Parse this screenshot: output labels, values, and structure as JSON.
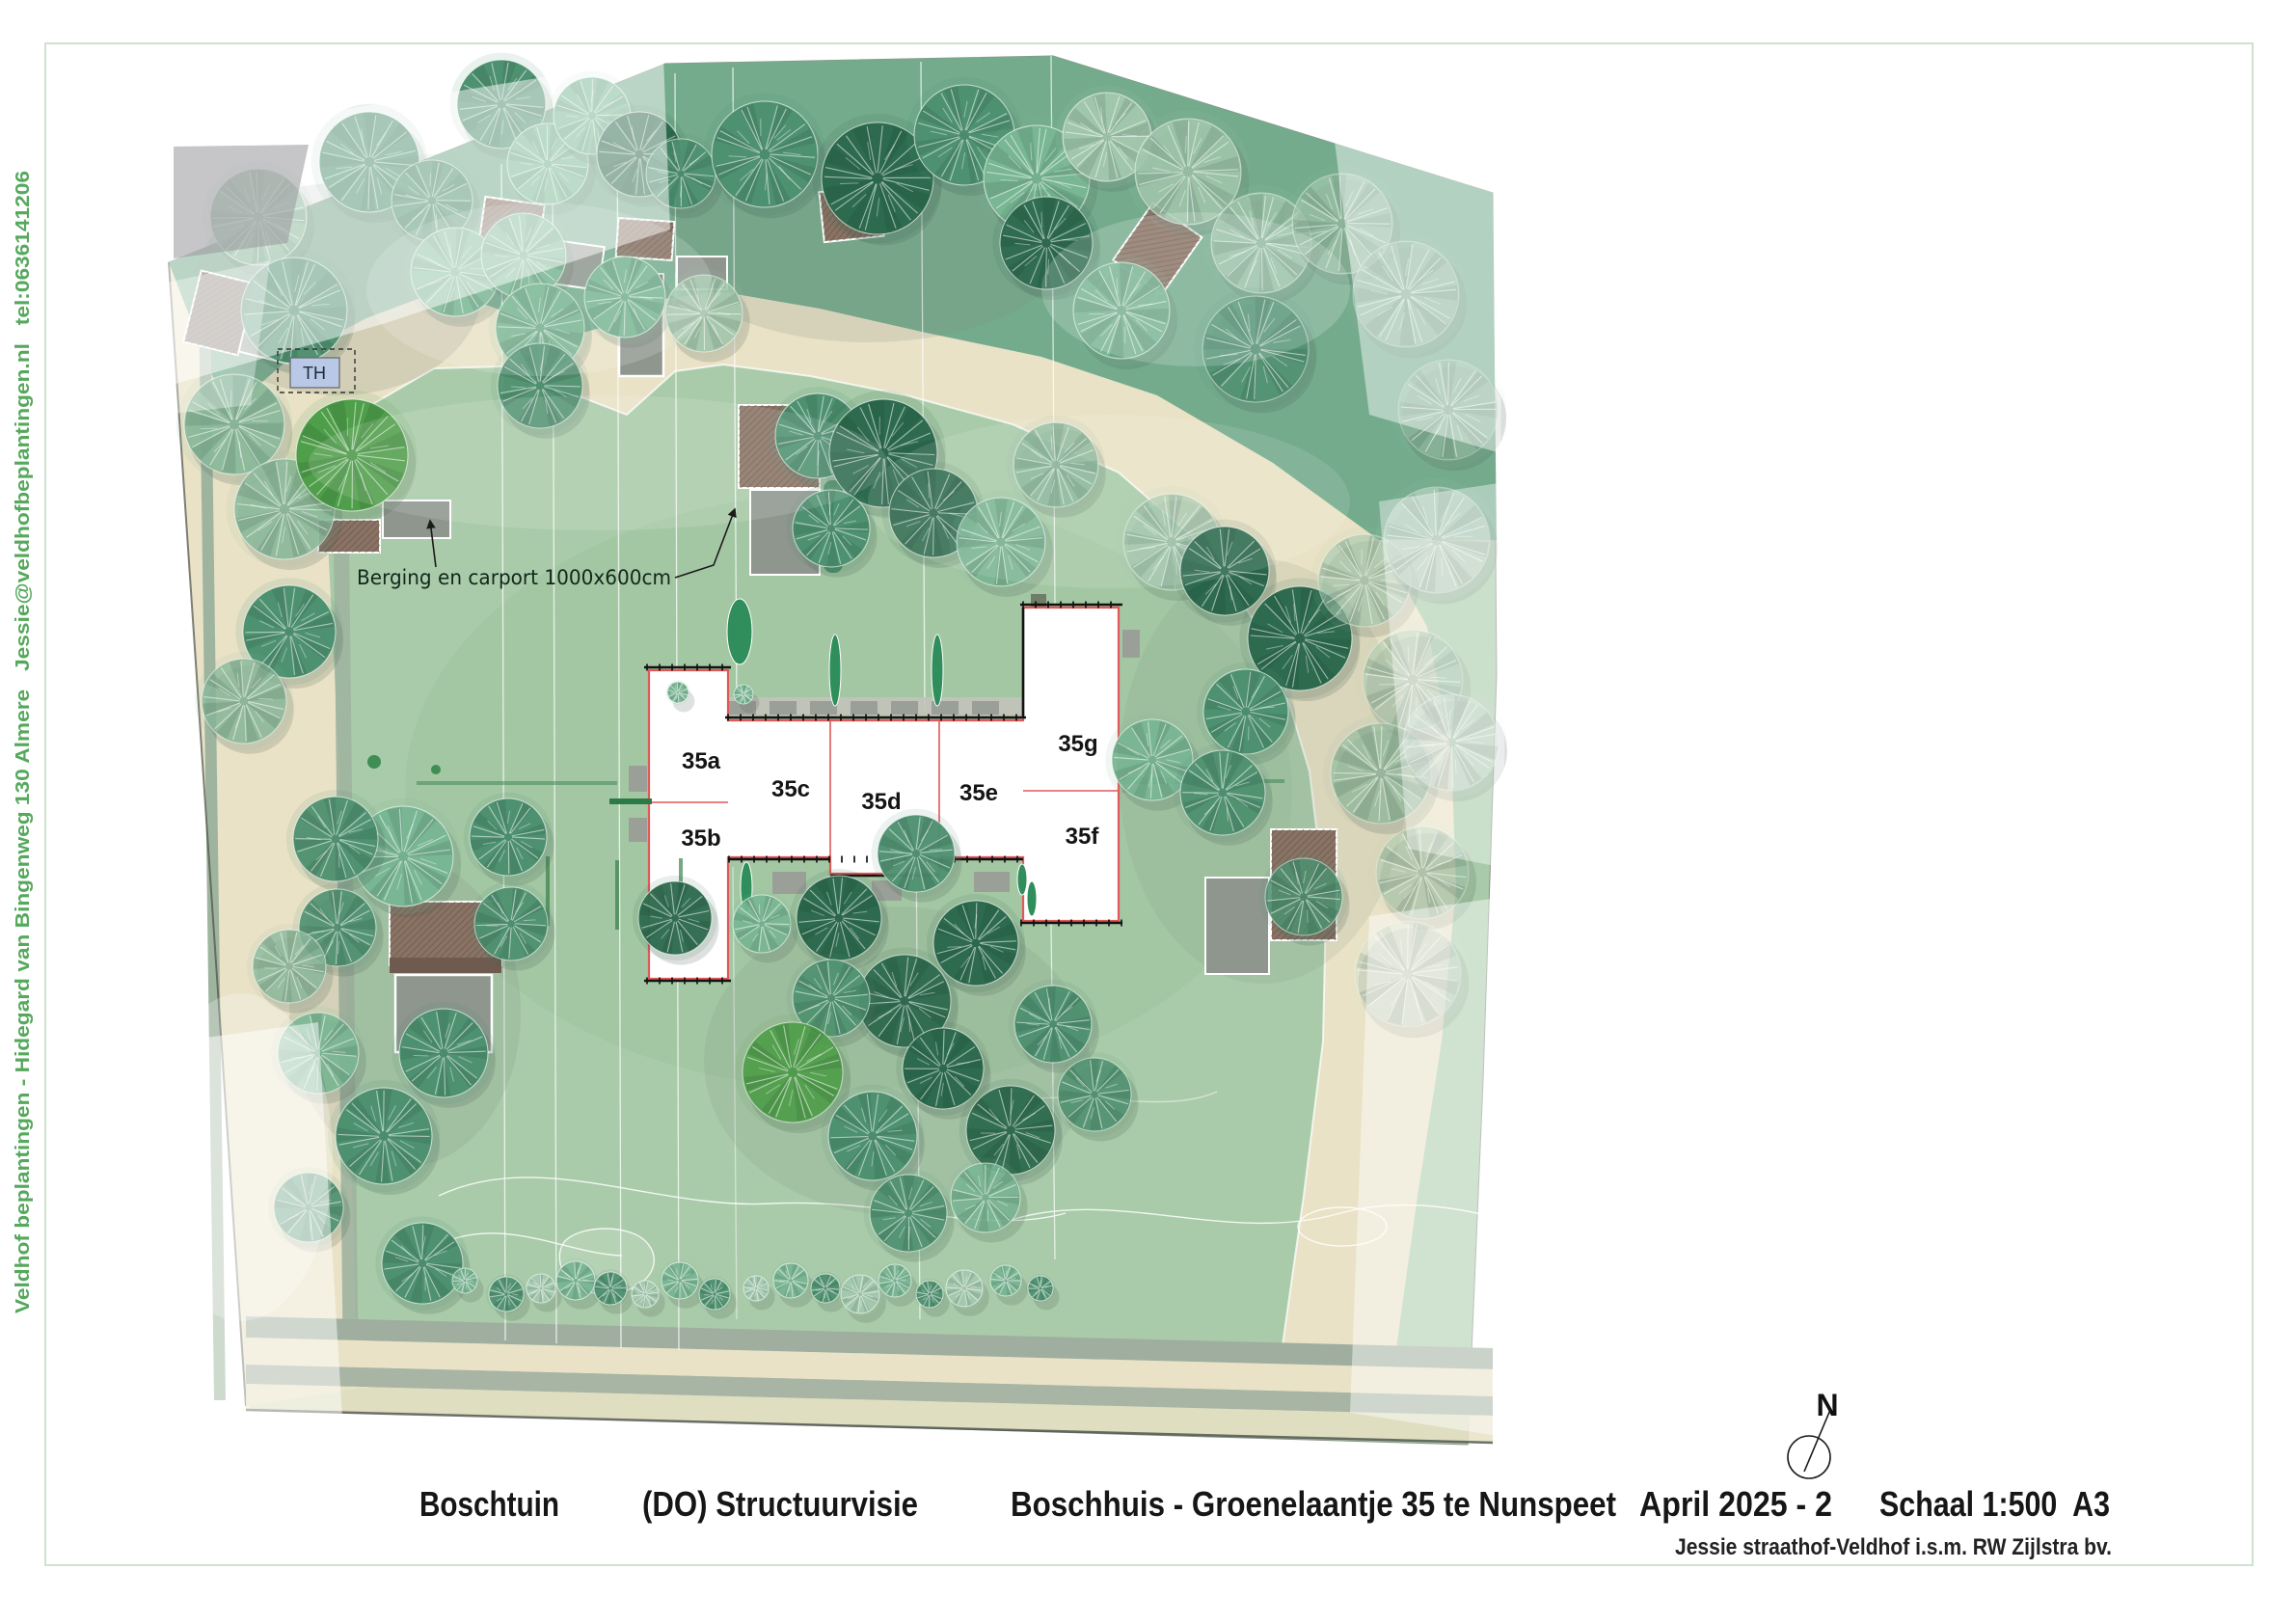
{
  "page": {
    "side_credit": "Veldhof beplantingen - Hidegard van Bingenweg 130 Almere   Jessie@veldhofbeplantingen.nl   tel:0636141206"
  },
  "plan": {
    "units": [
      "35a",
      "35b",
      "35c",
      "35d",
      "35e",
      "35f",
      "35g"
    ],
    "berging_annotation": "Berging en carport 1000x600cm",
    "tiny_house_label": "TH",
    "compass_label": "N"
  },
  "titleblock": {
    "project": "Boschtuin",
    "phase": "(DO) Structuurvisie",
    "address": "Boschhuis - Groenelaantje 35 te Nunspeet",
    "date": "April 2025 - 2",
    "scale": "Schaal 1:500  A3",
    "credit": "Jessie straathof-Veldhof i.s.m. RW Zijlstra bv."
  },
  "colors": {
    "lawn": "#a9cba9",
    "forest_band": "#74ab8d",
    "path_beige": "#e9e2c6",
    "accent_text_green": "#56a85c",
    "unit_outline_red": "#e05858",
    "roof_brown": "#8a7365",
    "shed_gray": "#8e968e",
    "tiny_house_fill": "#b9c8e6"
  }
}
